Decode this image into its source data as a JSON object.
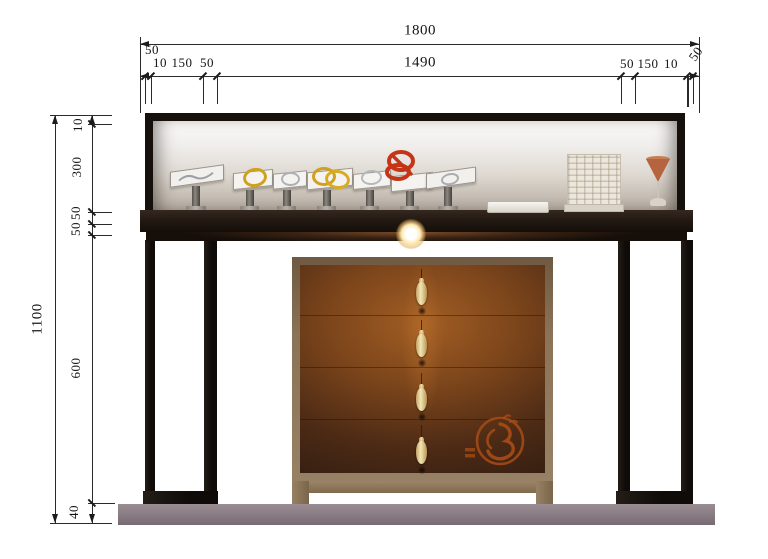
{
  "drawing": {
    "type": "elevation-drawing",
    "subject": "jewelry display counter with glass vitrine, drawer cabinet and plinth"
  },
  "dims_top": {
    "overall": "1800",
    "span": "1490",
    "left": [
      "50",
      "10",
      "150",
      "50"
    ],
    "right": [
      "50",
      "150",
      "10",
      "50"
    ]
  },
  "dims_left": {
    "overall": "1100",
    "segments": [
      "10",
      "300",
      "50",
      "50",
      "600",
      "40"
    ]
  },
  "palette": {
    "dimension_line": "#1c1c1c",
    "frame_black": "#16100c",
    "counter_brown": "#231a13",
    "base_gray": "#8b7e85",
    "cabinet_wood": "#8a735e",
    "cabinet_glow": "#9a5420",
    "handle_ivory": "#f3e6b4",
    "emblem_orange": "#a84c16",
    "gold": "#cfa11c",
    "silver": "#aeb2b6",
    "red_coral": "#c63418",
    "goblet_orange": "#b5643f"
  }
}
